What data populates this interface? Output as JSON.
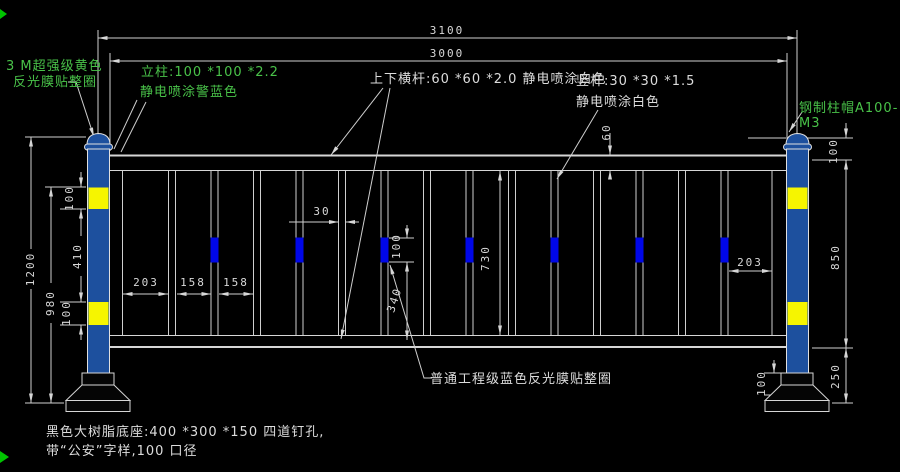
{
  "notes": {
    "film_yellow_1": "3 M超强级黄色",
    "film_yellow_2": "反光膜贴整圈",
    "post_spec_1": "立柱:100 *100 *2.2",
    "post_spec_2": "静电喷涂警蓝色",
    "rail_spec": "上下横杆:60 *60 *2.0 静电喷涂白色",
    "bar_spec_1": "竖杆:30 *30 *1.5",
    "bar_spec_2": "静电喷涂白色",
    "cap_spec": "钢制柱帽A100- M3",
    "film_blue": "普通工程级蓝色反光膜贴整圈",
    "base_spec_1": "黑色大树脂底座:400 *300 *150  四道钉孔,",
    "base_spec_2": "带“公安”字样,100 口径"
  },
  "dims": {
    "span_outer": "3100",
    "span_inner": "3000",
    "rail_height": "60",
    "cap_to_rail": "100",
    "fence_height": "850",
    "bottom_clearance": "250",
    "base_collar": "100",
    "total_height": "1200",
    "post_height": "980",
    "band_top": "100",
    "band_gap": "410",
    "band_bottom": "100",
    "end_gap_left": "203",
    "bar_gap_1": "158",
    "bar_gap_2": "158",
    "bar_width": "30",
    "patch_height": "100",
    "patch_to_bottom": "340",
    "clear_height": "730",
    "end_gap_right": "203"
  },
  "colors": {
    "background": "#000000",
    "line": "#d6d6d6",
    "text": "#d8d8d8",
    "annotation_green": "#49c249",
    "post_blue": "#1d509e",
    "band_yellow": "#f6f500",
    "patch_blue": "#0007e8"
  }
}
